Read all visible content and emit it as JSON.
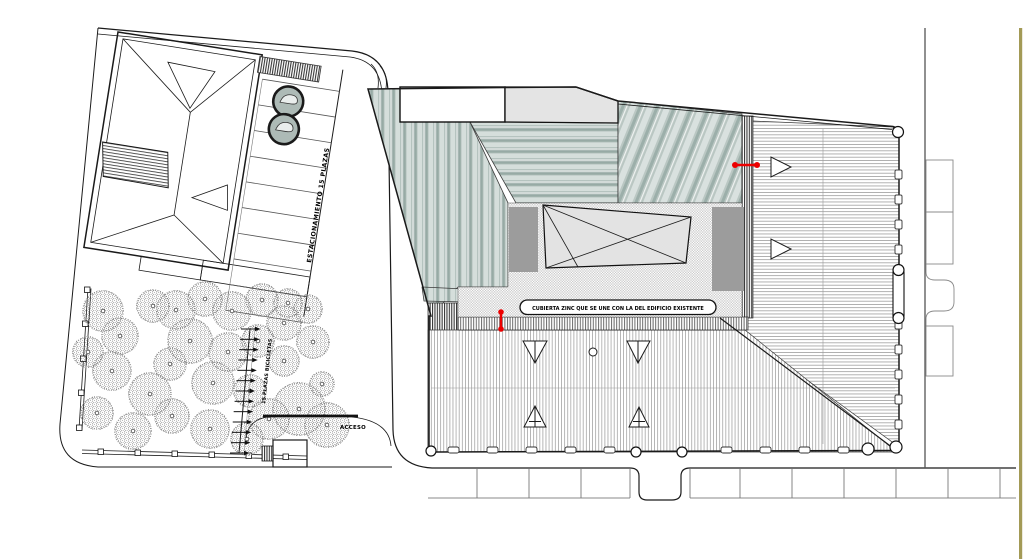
{
  "labels": {
    "parking": "ESTACIONAMIENTO 15 PLAZAS",
    "bikes": "15 PLAZAS BICICLETAS",
    "access": "ACCESO",
    "roof_note": "CUBIERTA ZINC QUE SE UNE CON LA DEL EDIFICIO EXISTENTE"
  },
  "colors": {
    "paper": "#ffffff",
    "line": "#1a1a1a",
    "teal_base": "#b5c3bf",
    "teal_light": "#d5dedb",
    "teal_dark": "#97aaa5",
    "grey_block": "#9c9c9c",
    "grey_facet": "#e3e3e3",
    "accent_red": "#ec0000",
    "page_edge_tan": "#a39a56"
  },
  "plan": {
    "trees": [
      [
        103,
        311,
        21
      ],
      [
        120,
        336,
        19
      ],
      [
        88,
        352,
        16
      ],
      [
        153,
        306,
        17
      ],
      [
        176,
        310,
        20
      ],
      [
        205,
        299,
        18
      ],
      [
        232,
        311,
        20
      ],
      [
        262,
        300,
        17
      ],
      [
        288,
        303,
        15
      ],
      [
        308,
        309,
        15
      ],
      [
        284,
        323,
        18
      ],
      [
        313,
        342,
        17
      ],
      [
        190,
        341,
        23
      ],
      [
        228,
        352,
        20
      ],
      [
        258,
        341,
        17
      ],
      [
        170,
        364,
        17
      ],
      [
        112,
        371,
        20
      ],
      [
        150,
        394,
        22
      ],
      [
        213,
        383,
        22
      ],
      [
        250,
        391,
        17
      ],
      [
        284,
        361,
        16
      ],
      [
        322,
        384,
        13
      ],
      [
        97,
        413,
        17
      ],
      [
        133,
        431,
        19
      ],
      [
        172,
        416,
        18
      ],
      [
        210,
        429,
        20
      ],
      [
        247,
        439,
        17
      ],
      [
        269,
        419,
        21
      ],
      [
        299,
        409,
        27
      ],
      [
        327,
        425,
        23
      ]
    ],
    "bike_racks": {
      "x1": 250,
      "y1": 329,
      "x2": 239,
      "y2": 453,
      "count": 13
    },
    "stalls": {
      "x1": 150,
      "x2": 228,
      "y_start": 24,
      "step": 26,
      "count": 10
    },
    "facade_squares": {
      "x_start": 448,
      "x_end": 864,
      "step": 39,
      "y": 447,
      "w": 11,
      "h": 6,
      "gap_min": 628,
      "gap_max": 690
    },
    "right_tabs": {
      "x": 895,
      "y_start": 170,
      "step": 25,
      "count": 11
    },
    "parking_dividers_left": [
      477,
      529,
      581,
      630
    ],
    "parking_dividers_right": [
      690,
      740,
      792,
      844,
      896,
      948,
      1000
    ],
    "divider_y": [
      469,
      498
    ]
  }
}
